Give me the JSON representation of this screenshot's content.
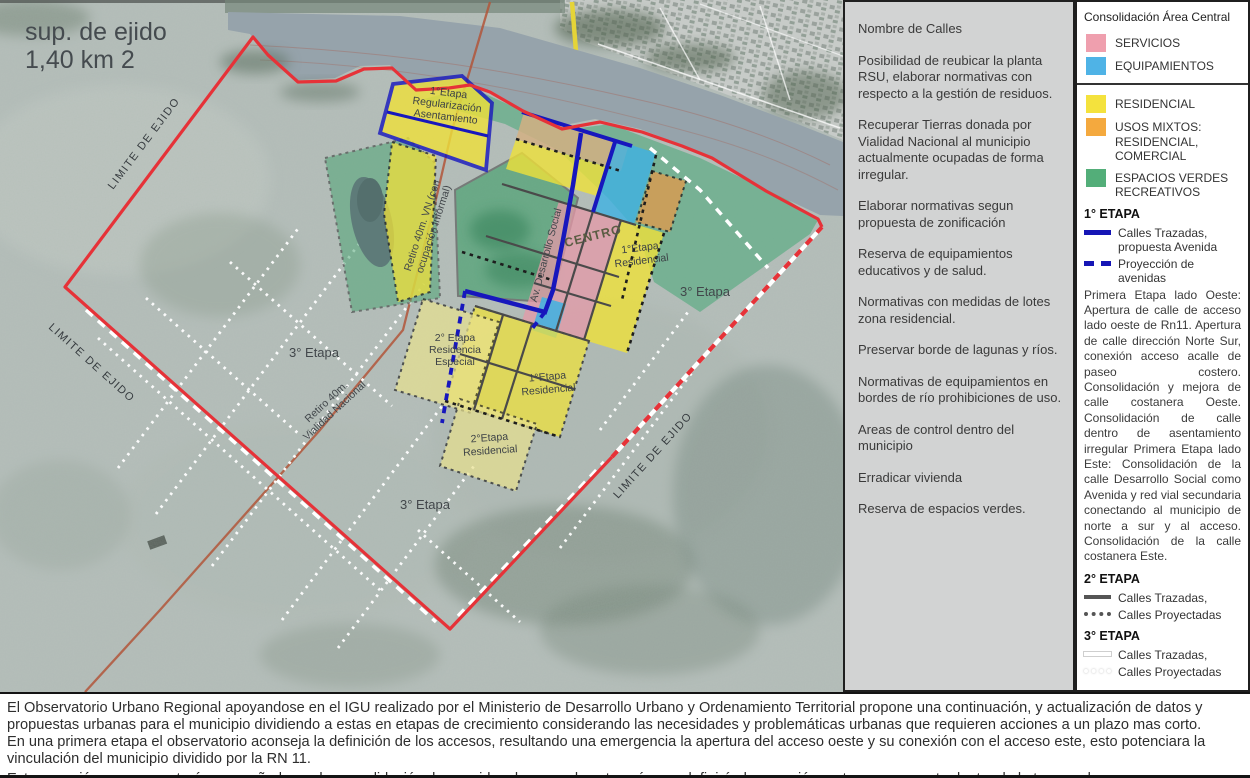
{
  "map": {
    "surface_label": [
      "sup. de ejido",
      "1,40 km 2"
    ],
    "labels": {
      "limite": "LIMITE DE EJIDO",
      "etapa3": "3° Etapa",
      "regularizacion": [
        "1°Etapa",
        "Regularización",
        "Asentamiento"
      ],
      "retiro_vn": [
        "Retiro 40m. VN (con",
        "ocupación informal)"
      ],
      "retiro_vialidad": [
        "Retiro 40m.",
        "Vialidad Nacional"
      ],
      "av_desarrollo": "Av. Desarrollo Social",
      "centro": "CENTRO",
      "etapa1_residencial": [
        "1°Etapa",
        "Residencial"
      ],
      "etapa2_especial": [
        "2° Etapa",
        "Residencia",
        "Especial"
      ],
      "etapa2_residencial": [
        "2°Etapa",
        "Residencial"
      ]
    }
  },
  "notes": {
    "items": [
      "Nombre de Calles",
      "Posibilidad  de reubicar la planta RSU, elaborar normativas con respecto a la gestión de residuos.",
      "Recuperar Tierras donada por Vialidad Nacional al municipio actualmente ocupadas de forma irregular.",
      "Elaborar normativas segun propuesta de zonificación",
      "Reserva de equipamientos educativos y de salud.",
      "Normativas con medidas de lotes zona residencial.",
      "Preservar borde de lagunas y ríos.",
      "Normativas de equipamientos en bordes de río prohibiciones de uso.",
      "Areas de control dentro del municipio",
      "Erradicar vivienda",
      "Reserva de espacios verdes."
    ]
  },
  "legend": {
    "title": "Consolidación Área Central",
    "zones": [
      {
        "label": "SERVICIOS",
        "color": "#ef9fae"
      },
      {
        "label": "EQUIPAMIENTOS",
        "color": "#4fb3e6"
      },
      {
        "label": "RESIDENCIAL",
        "color": "#f4e23d"
      },
      {
        "label": "USOS MIXTOS: RESIDENCIAL, COMERCIAL",
        "color": "#f4a93e"
      },
      {
        "label": "ESPACIOS VERDES RECREATIVOS",
        "color": "#53ae79"
      }
    ],
    "etapa1": {
      "title": "1° ETAPA",
      "accent": "#1515b5",
      "items": [
        {
          "label": "Calles Trazadas, propuesta Avenida"
        },
        {
          "label": "Proyección de avenidas"
        }
      ],
      "paragraph": "Primera Etapa lado Oeste: Apertura de calle de acceso lado oeste de Rn11. Apertura de calle dirección Norte Sur, conexión acceso acalle de paseo costero. Consolidación y mejora de calle costanera Oeste. Consolidación de calle dentro de asentamiento irregular Primera Etapa lado Este: Consolidación de la calle Desarrollo Social como Avenida y red vial secundaria conectando al municipio de norte a sur y al acceso. Consolidación de la calle costanera Este."
    },
    "etapa2": {
      "title": "2° ETAPA",
      "accent": "#555555",
      "items": [
        {
          "label": "Calles Trazadas,"
        },
        {
          "label": "Calles Proyectadas"
        }
      ]
    },
    "etapa3": {
      "title": "3° ETAPA",
      "accent": "#ffffff",
      "items": [
        {
          "label": "Calles Trazadas,"
        },
        {
          "label": "Calles Proyectadas"
        }
      ]
    }
  },
  "footer": {
    "lines": [
      "El Observatorio Urbano Regional apoyandose en el IGU realizado por el Ministerio de Desarrollo Urbano y Ordenamiento Territorial propone una continuación, y actualización de datos y",
      "propuestas urbanas para el municipio dividiendo a estas en etapas de crecimiento considerando las necesidades y problemáticas urbanas que requieren acciones a un plazo mas corto.",
      "En una primera etapa el observatorio aconseja la definición de los accesos, resultando una emergencia la apertura del acceso oeste y su conexión con el acceso este, esto potenciara la",
      "vinculación del municipio dividido por la RN 11.",
      "Esta conexión a su vez estará acompañado por la consolidación de avenidas de segunda categoría que definirán la conexión norte-sur y sur-este dentro de la trama urbana."
    ]
  },
  "colors": {
    "boundary_red": "#e63238",
    "avenue_blue": "#1515b5",
    "etapa2_gray": "#555555",
    "etapa3_white": "#ffffff"
  }
}
